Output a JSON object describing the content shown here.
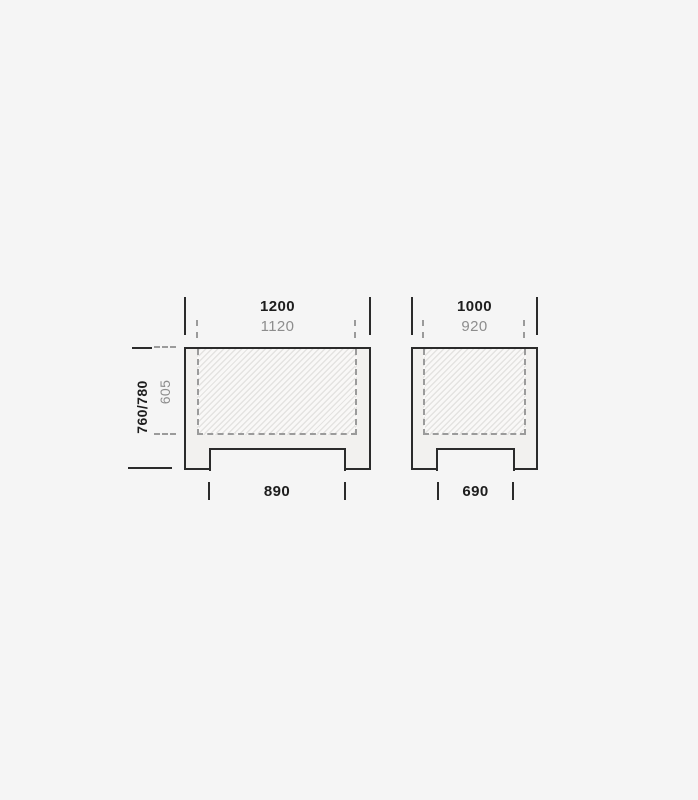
{
  "diagram": {
    "kind": "furniture-front-elevation-dimension-drawing",
    "tables": [
      {
        "id": "left",
        "outer_width": "1200",
        "inner_width": "1120",
        "overall_height": "760/780",
        "clearance_height": "605",
        "leg_inner_span": "890"
      },
      {
        "id": "right",
        "outer_width": "1000",
        "inner_width": "920",
        "leg_inner_span": "690"
      }
    ],
    "colors": {
      "background": "#f5f5f5",
      "outline_dark": "#2b2b2b",
      "text_dark": "#1d1d1d",
      "text_gray": "#8d8d8d",
      "dashed_gray": "#9b9b9b",
      "table_fill": "#f2f1ef",
      "hatch_line": "#e4e3e1",
      "hatch_bg": "#f9f8f7"
    }
  }
}
